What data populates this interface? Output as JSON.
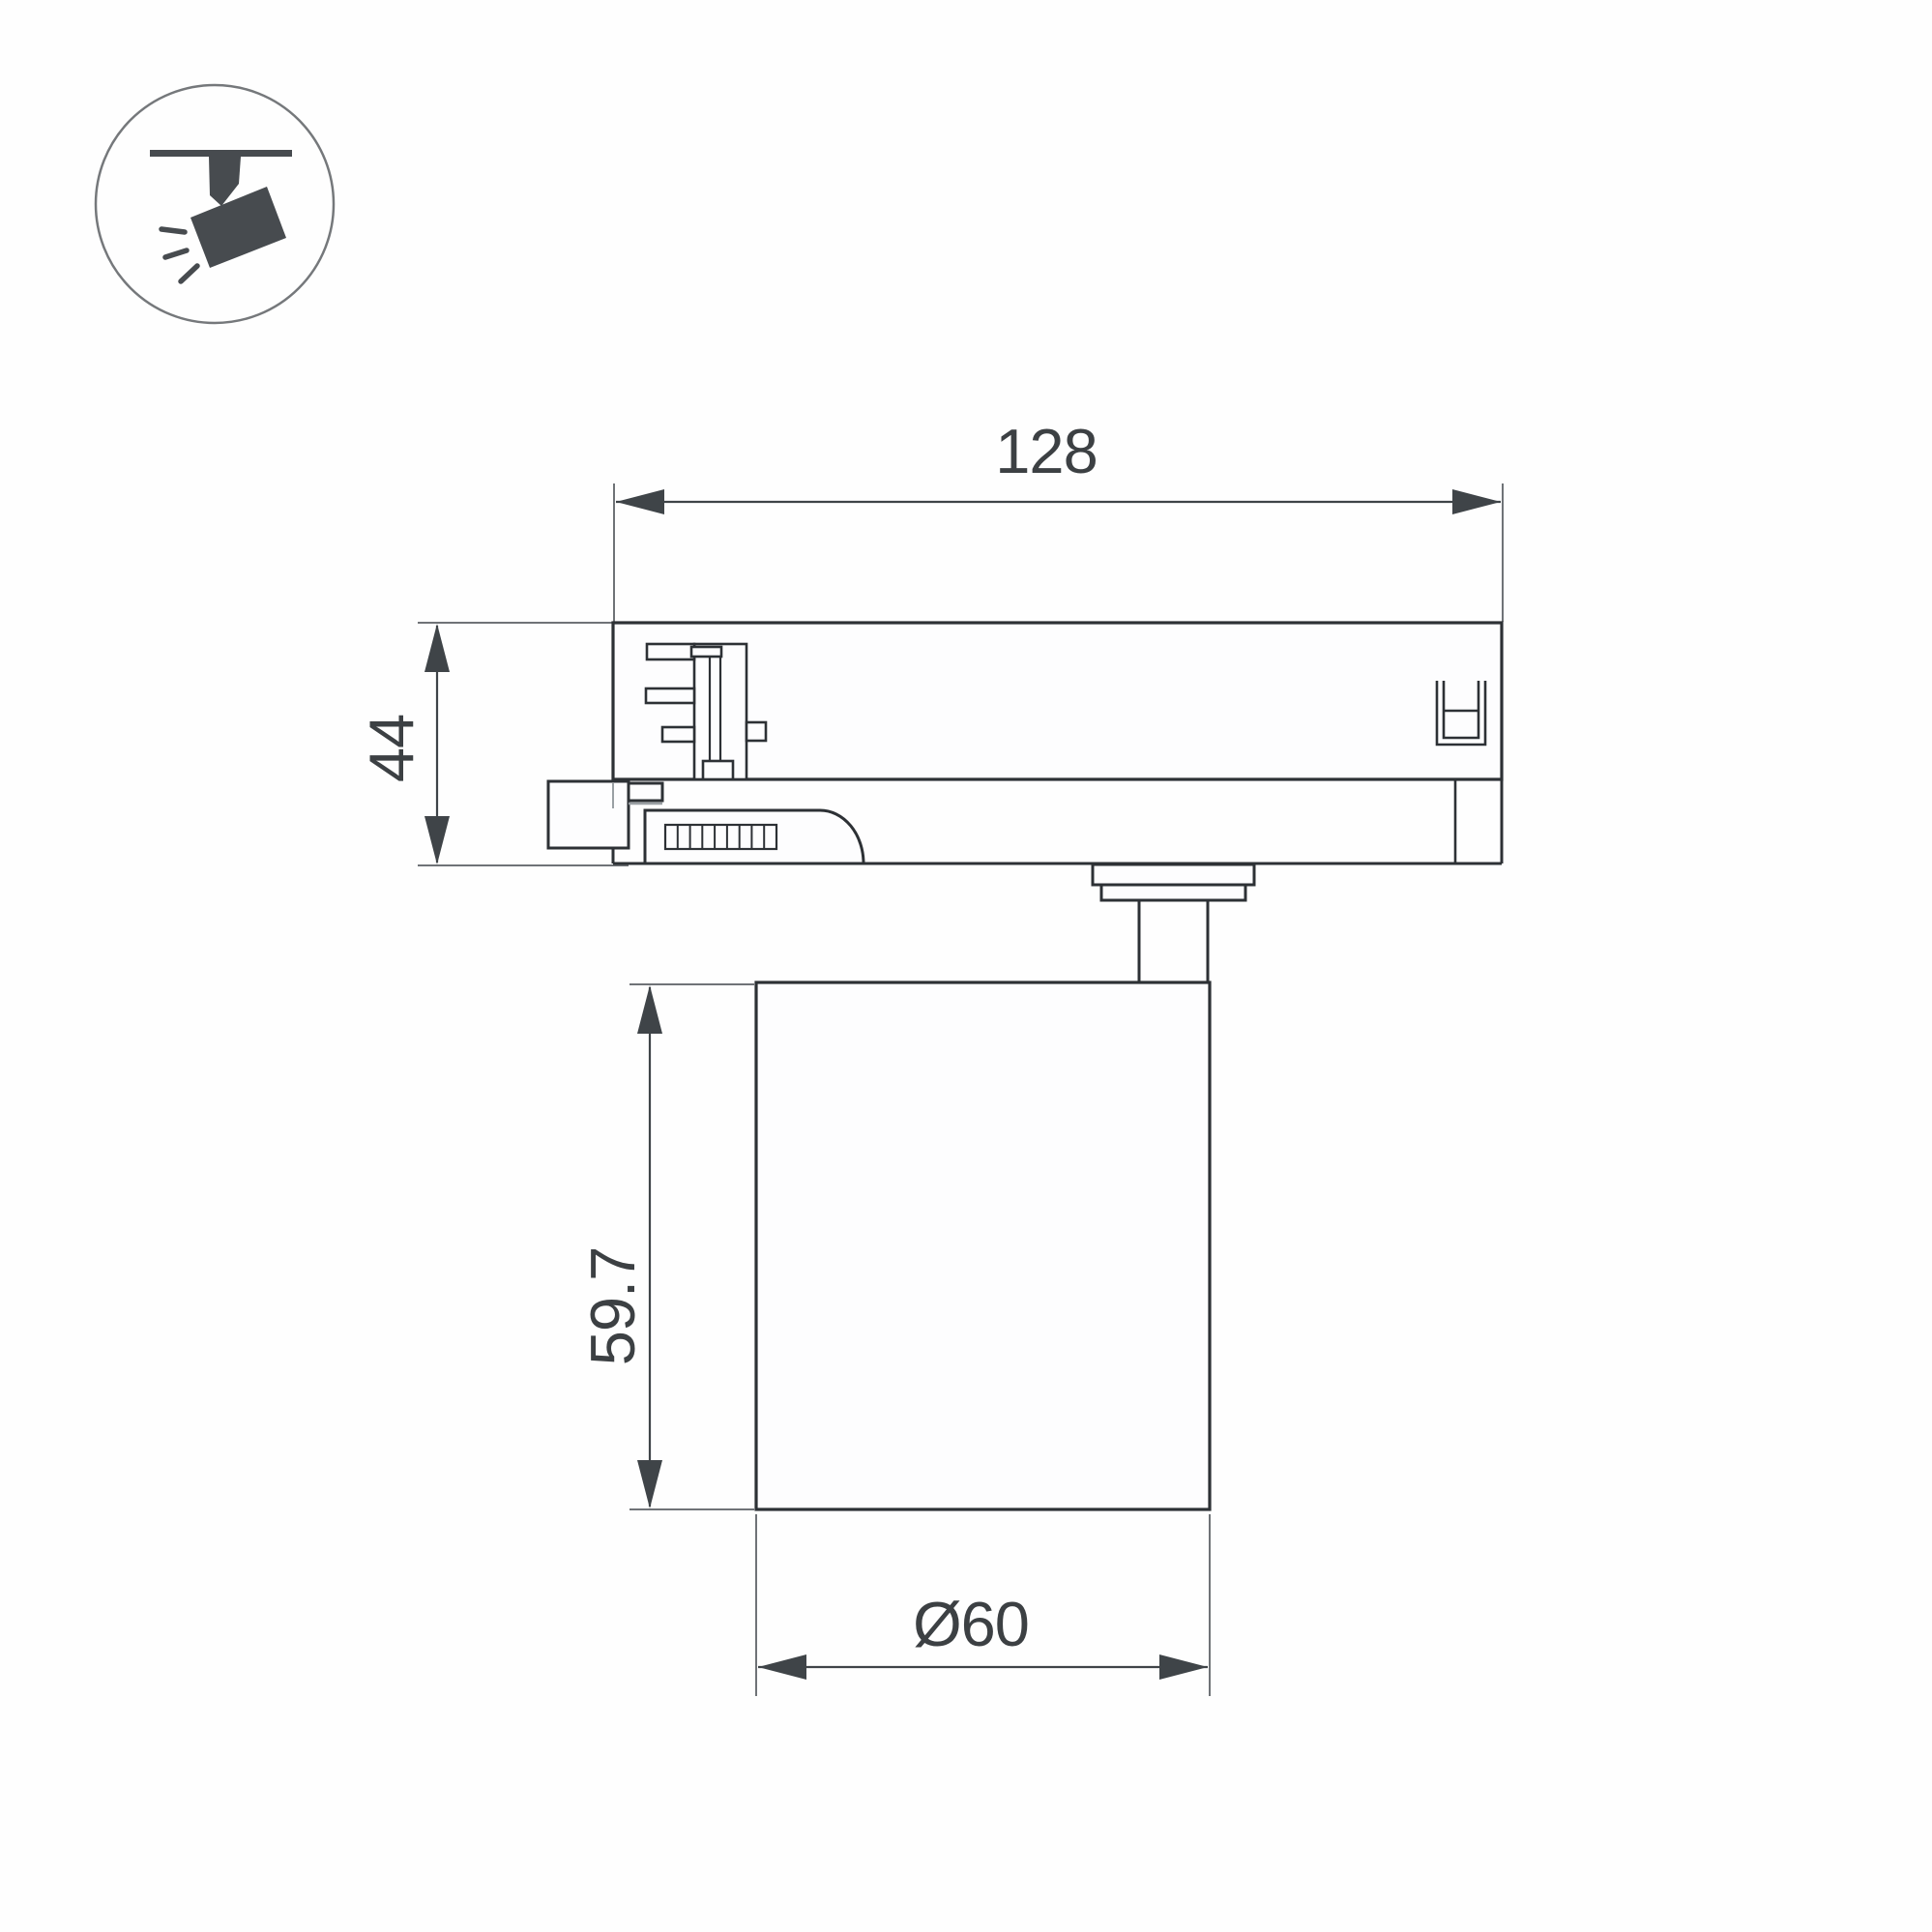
{
  "drawing": {
    "kind": "dimensioned-technical-drawing",
    "view": "side-view-track-spotlight",
    "dimensions": {
      "track_width": {
        "label": "128"
      },
      "adapter_height": {
        "label": "44"
      },
      "body_height": {
        "label": "59.7"
      },
      "body_diameter": {
        "label": "Ø60"
      }
    }
  },
  "icon": {
    "name": "track-spotlight-badge",
    "parts": [
      "ceiling-track",
      "mount-stem",
      "tilted-lamp-head",
      "light-rays"
    ]
  },
  "colors": {
    "page_bg": "#fefefe",
    "part_fill": "#fdfdfe",
    "outline": "#2d3135",
    "dimension": "#3f4448",
    "extension": "#6f7377",
    "lightline": "#9aa0a4",
    "text": "#3c4043",
    "icon": "#474b4f",
    "circle": "#75787b"
  }
}
